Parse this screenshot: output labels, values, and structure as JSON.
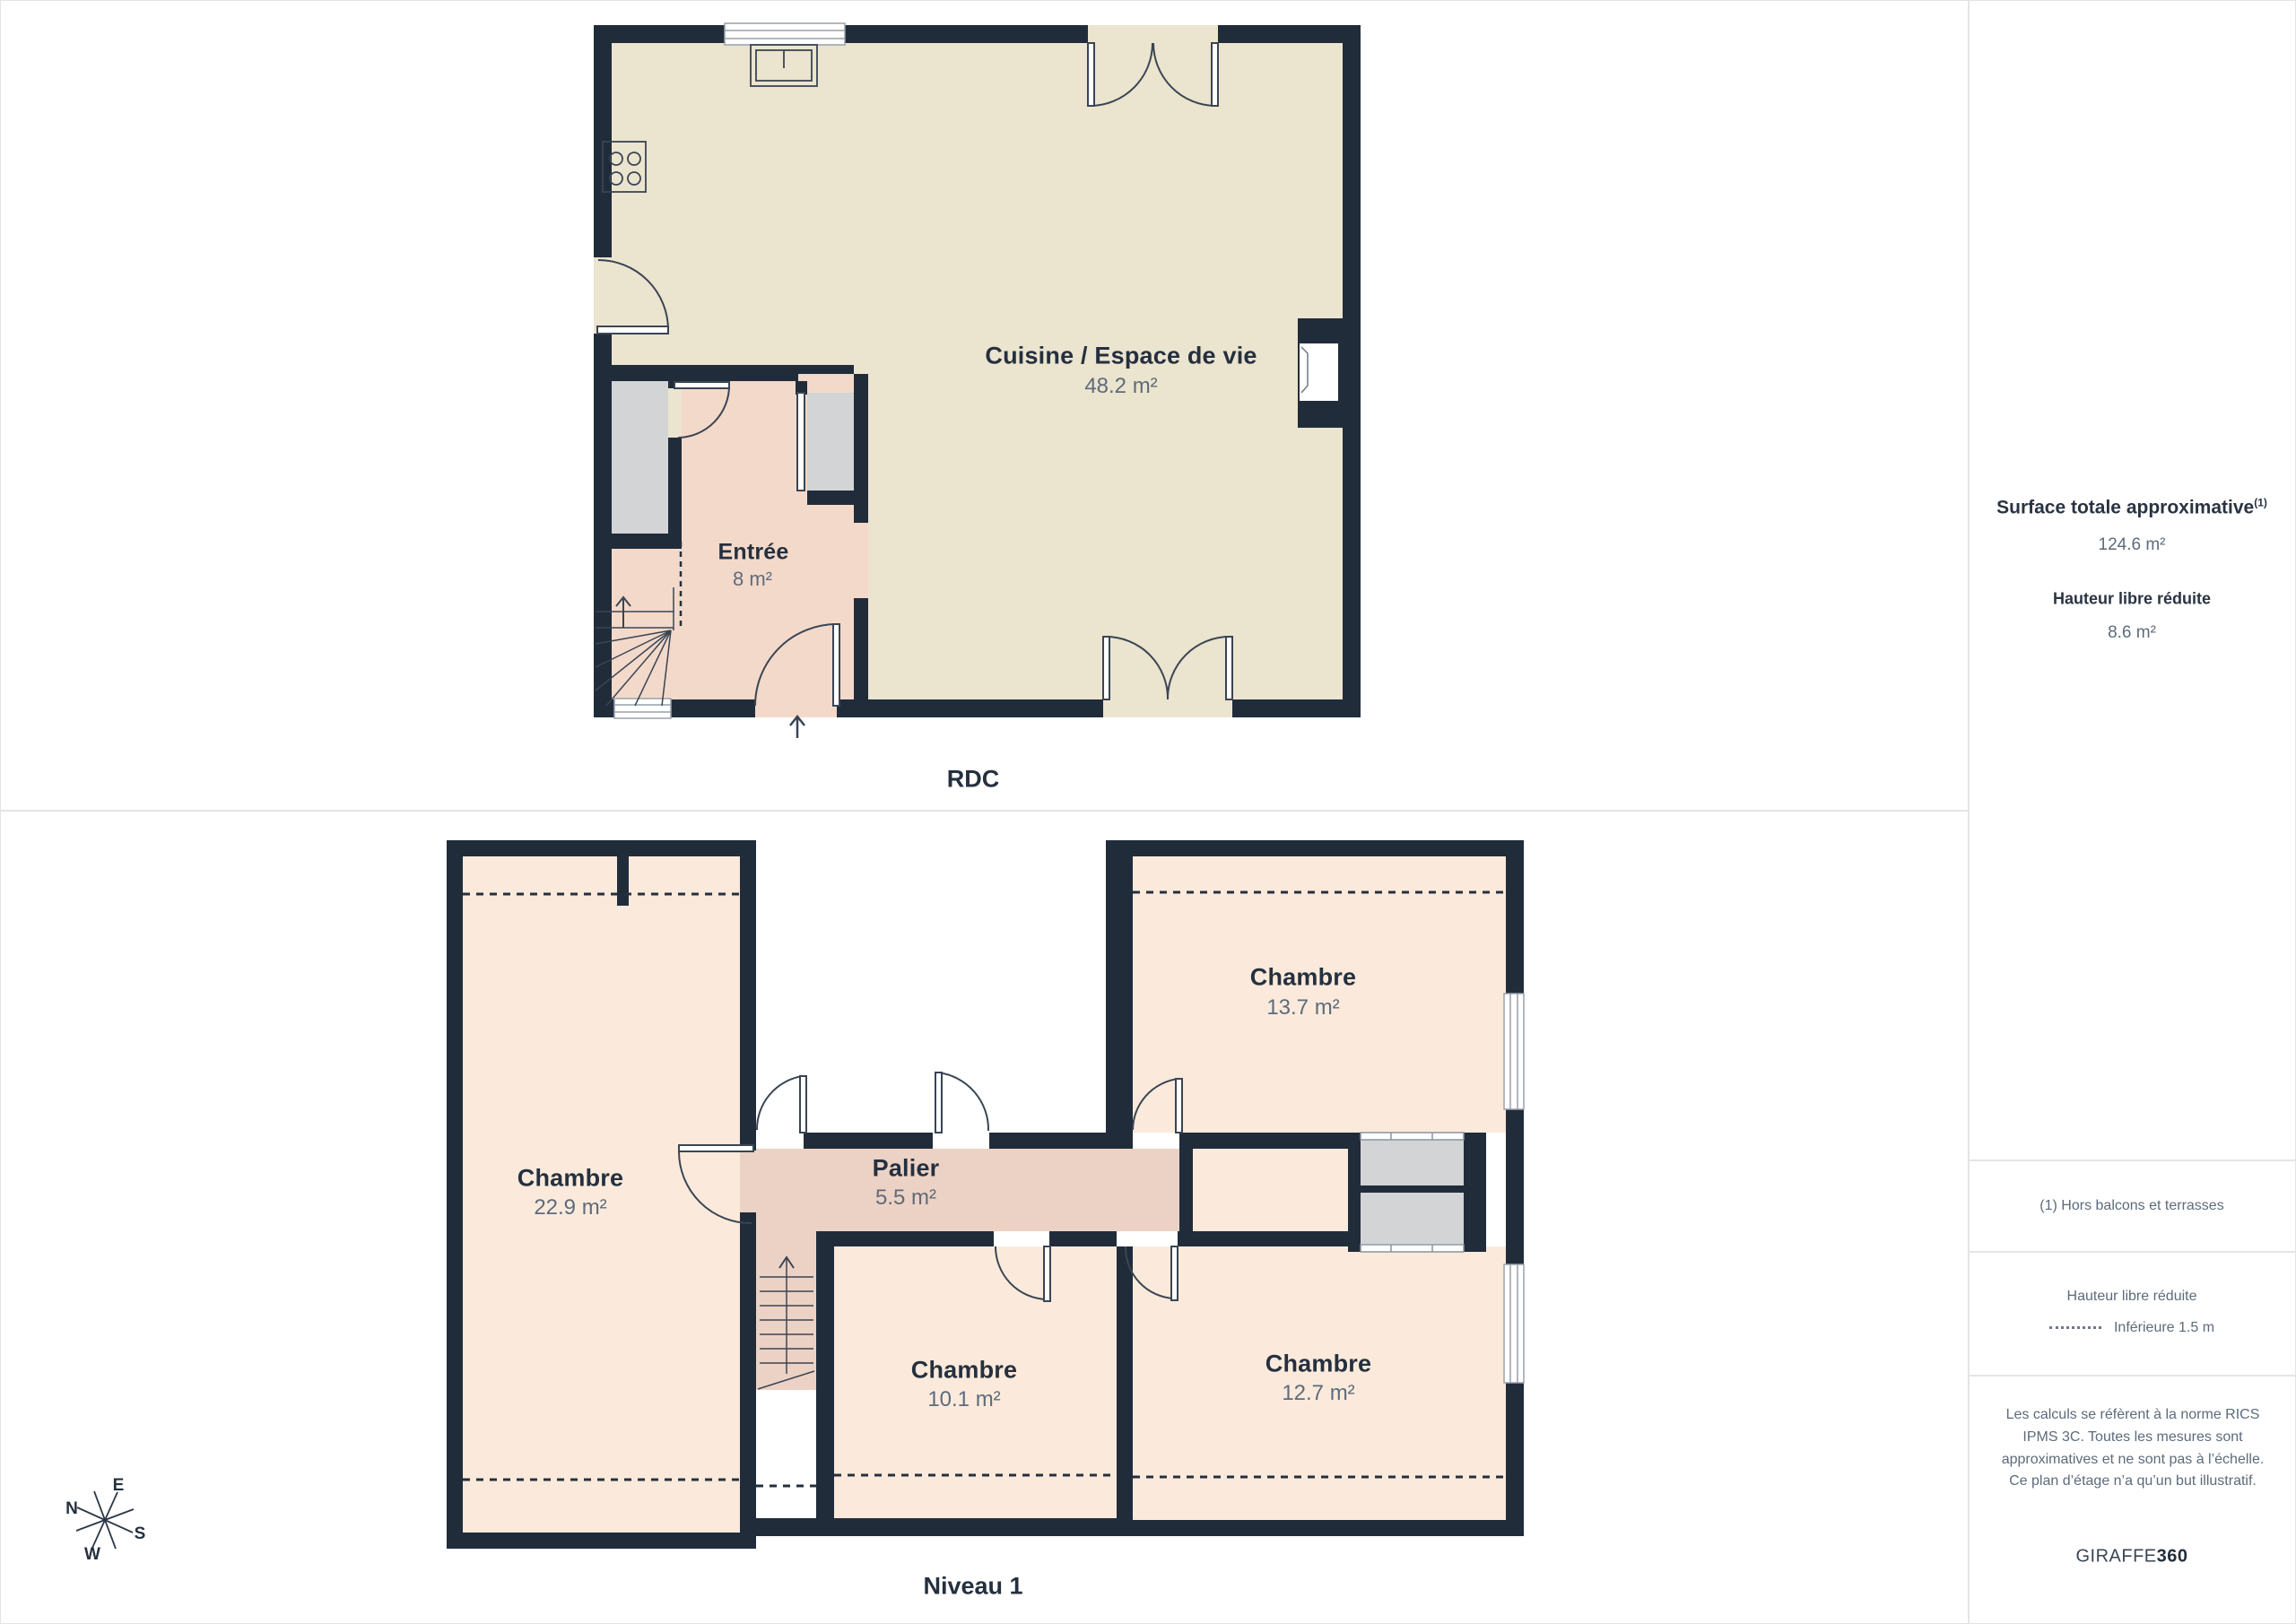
{
  "floors": {
    "rdc": {
      "label": "RDC",
      "rooms": {
        "cuisine": {
          "name": "Cuisine / Espace de vie",
          "area": "48.2 m²"
        },
        "entree": {
          "name": "Entrée",
          "area": "8 m²"
        }
      }
    },
    "niveau1": {
      "label": "Niveau 1",
      "rooms": {
        "chambre_grande": {
          "name": "Chambre",
          "area": "22.9 m²"
        },
        "palier": {
          "name": "Palier",
          "area": "5.5 m²"
        },
        "chambre_ne": {
          "name": "Chambre",
          "area": "13.7 m²"
        },
        "chambre_sud": {
          "name": "Chambre",
          "area": "10.1 m²"
        },
        "chambre_se": {
          "name": "Chambre",
          "area": "12.7 m²"
        }
      }
    }
  },
  "sidebar": {
    "total_title": "Surface totale approximative",
    "total_superscript": "(1)",
    "total_value": "124.6 m²",
    "reduced_title": "Hauteur libre réduite",
    "reduced_value": "8.6 m²",
    "footnote": "(1) Hors balcons et terrasses",
    "legend_title": "Hauteur libre réduite",
    "legend_item": "Inférieure 1.5 m",
    "disclaimer": "Les calculs se réfèrent à la norme RICS IPMS 3C. Toutes les mesures sont approximatives et ne sont pas à l’échelle. Ce plan d’étage n’a qu’un but illustratif.",
    "brand_name": "GIRAFFE",
    "brand_suffix": "360"
  },
  "compass": {
    "n": "N",
    "e": "E",
    "s": "S",
    "w": "W"
  },
  "colors": {
    "wall": "#212c3b",
    "kitchen_floor": "#ebe4ce",
    "hall_floor": "#f3d9ca",
    "landing_floor": "#ecd2c4",
    "bedroom_floor": "#fbeadb",
    "closet_fill": "#d2d4d6",
    "label": "#25303f",
    "value": "#5d6b7b"
  }
}
